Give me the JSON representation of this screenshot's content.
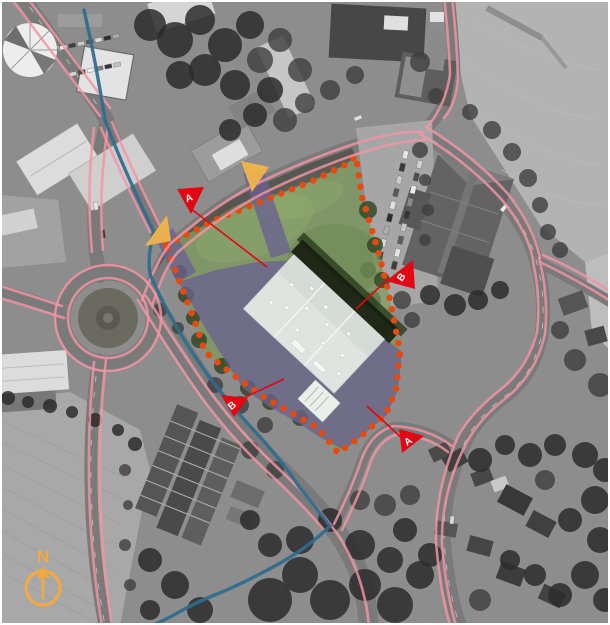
{
  "map": {
    "kind": "aerial-site-plan",
    "compass": {
      "label": "N"
    },
    "viewpoint_markers": [
      {
        "id": "viewpoint-a-north",
        "letter": "A"
      },
      {
        "id": "viewpoint-b-east",
        "letter": "B"
      },
      {
        "id": "viewpoint-b-south",
        "letter": "B"
      },
      {
        "id": "viewpoint-a-southeast",
        "letter": "A"
      }
    ],
    "entrance_arrows": [
      {
        "id": "entrance-arrow-west"
      },
      {
        "id": "entrance-arrow-north"
      }
    ]
  },
  "colors": {
    "road-highlight": "#f494a4",
    "cycle-route": "#2f6c8e",
    "site-boundary": "#e8490f",
    "site-green": "#7a9b55",
    "site-paved": "#6a6191",
    "new-building": "#dfe4e0",
    "entrance-arrow": "#f0b44c",
    "marker-red": "#e30613",
    "north-arrow": "#f2a93f"
  }
}
